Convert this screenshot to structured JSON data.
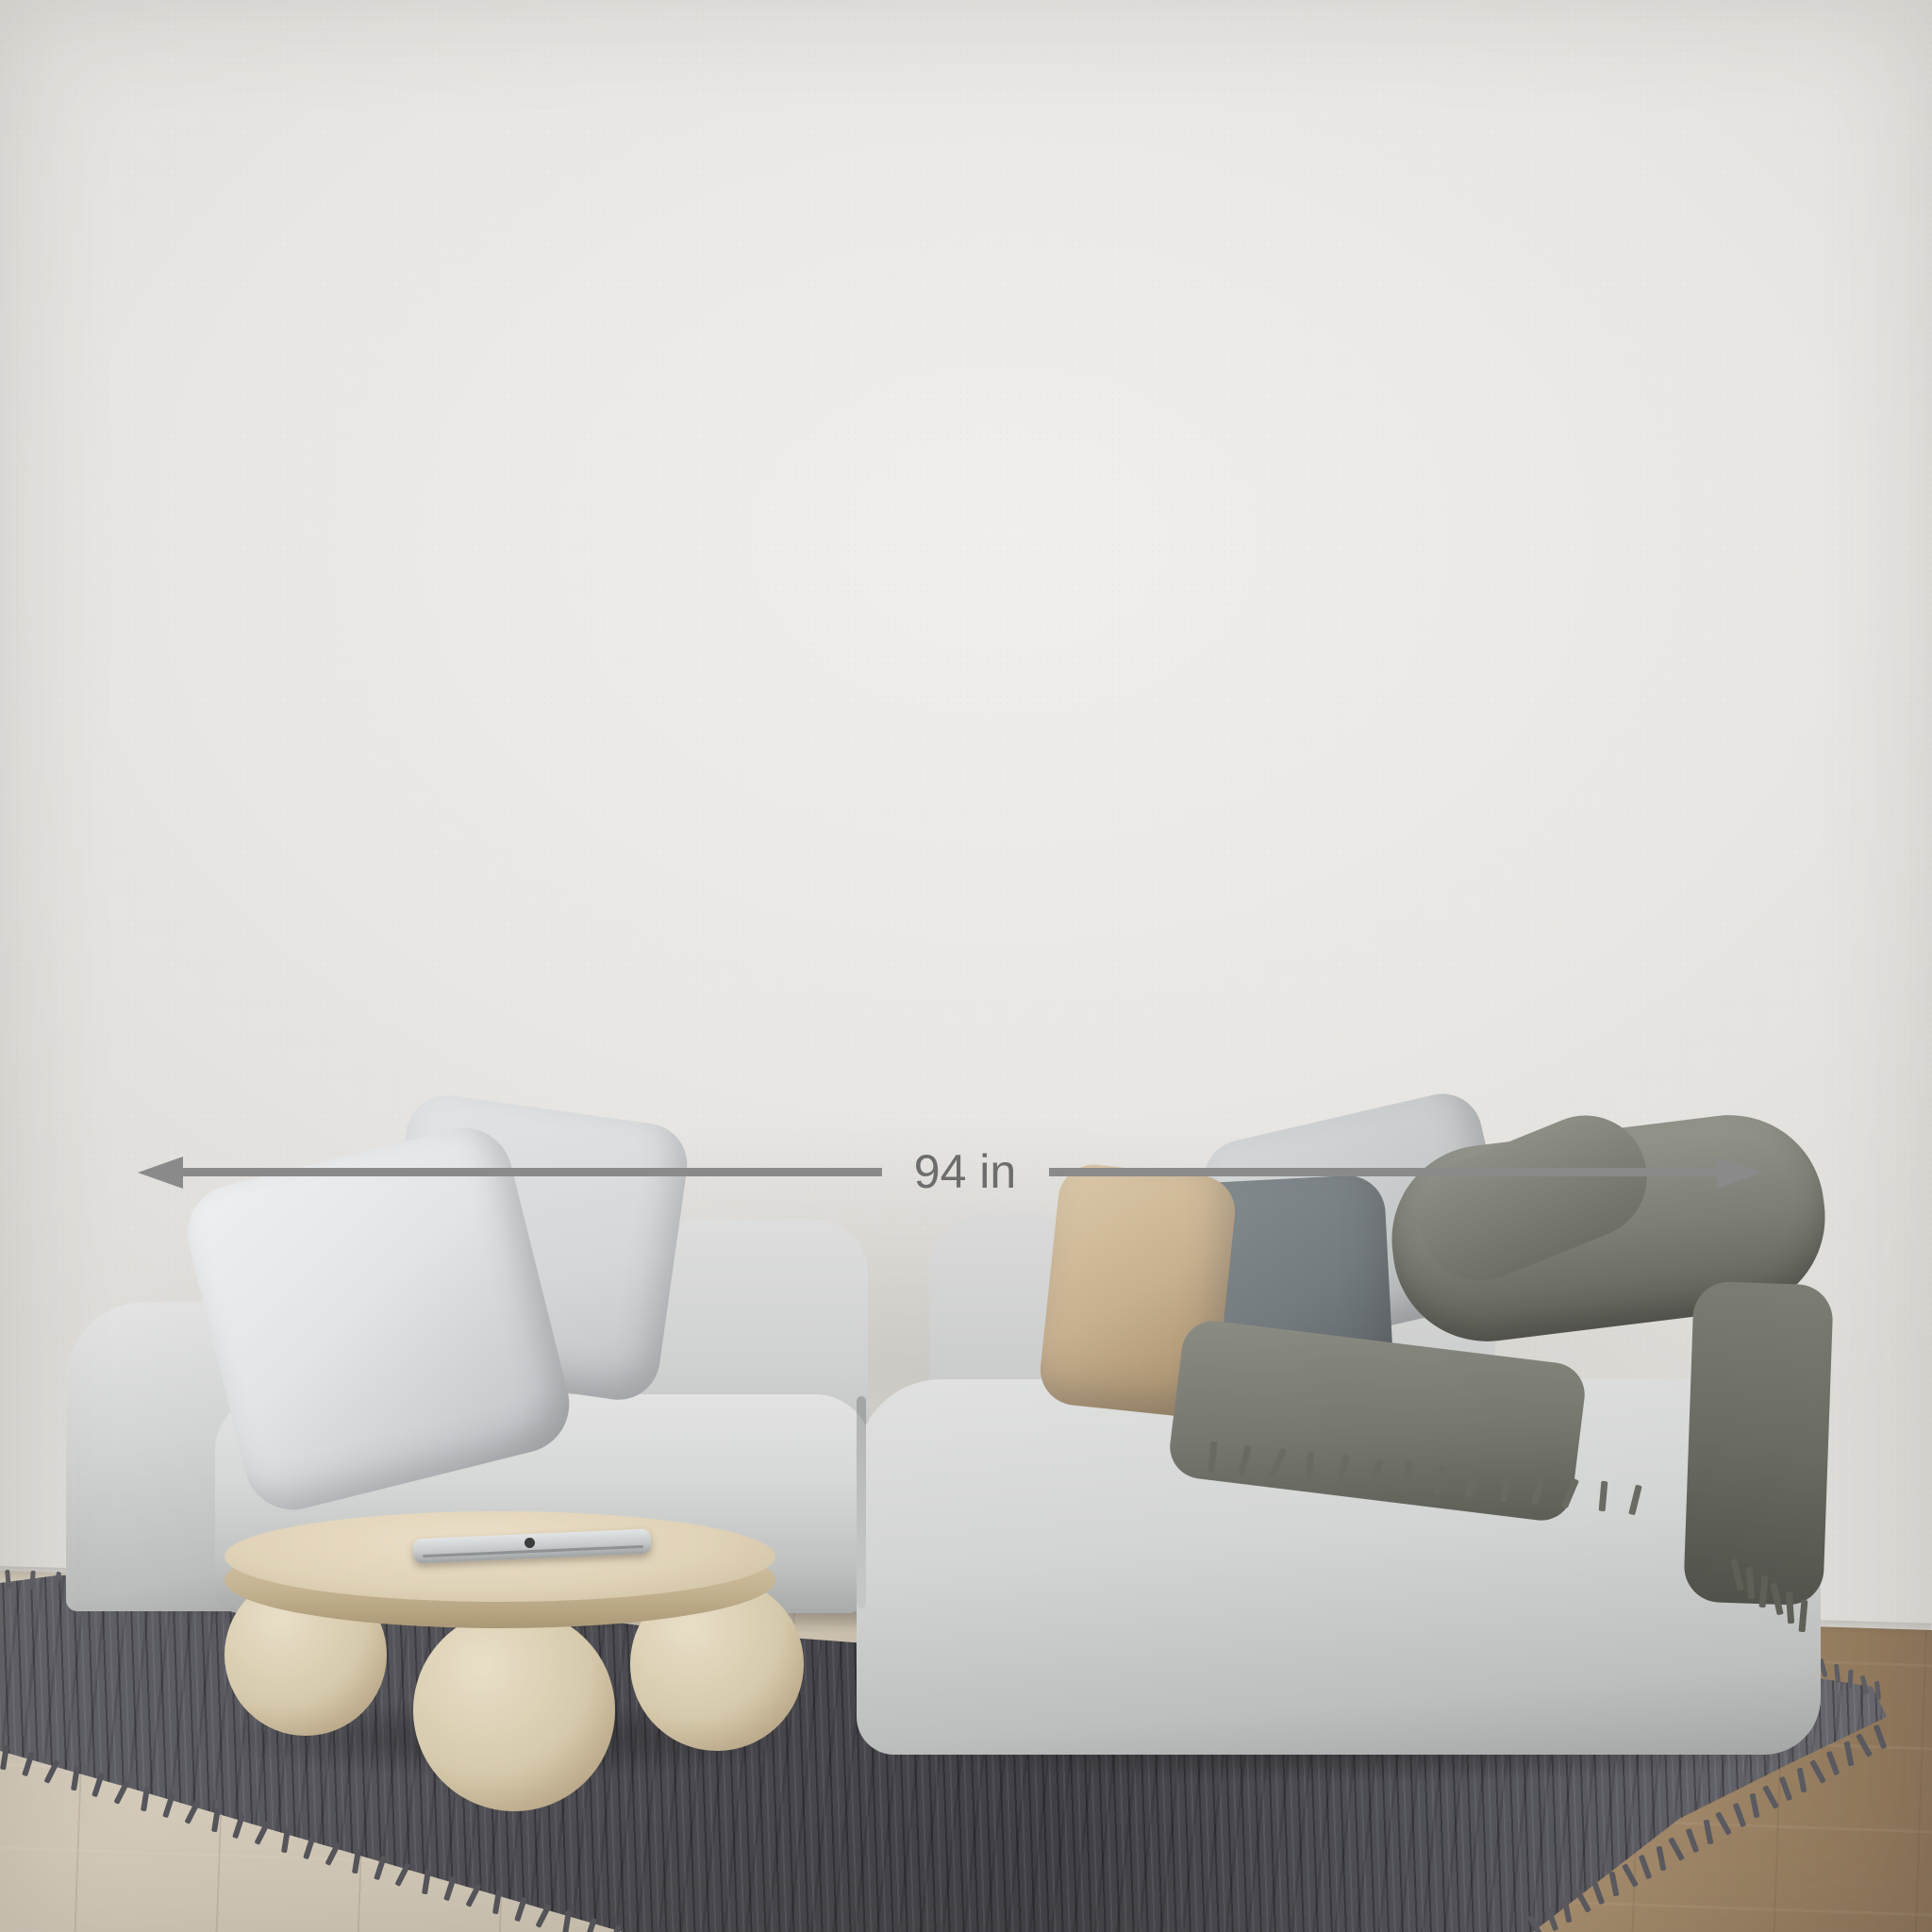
{
  "size_guide": {
    "line_color": "#7a7a7a",
    "label_color": "#747474",
    "sizes": [
      {
        "label": "90 in X 60 in",
        "width_in": 90,
        "height_in": 60
      },
      {
        "label": "72 in X 48 in",
        "width_in": 72,
        "height_in": 48
      },
      {
        "label": "60 in X 40 in",
        "width_in": 60,
        "height_in": 40
      },
      {
        "label": "48 in X 32 in",
        "width_in": 48,
        "height_in": 32
      },
      {
        "label": "36 in X 24 in",
        "width_in": 36,
        "height_in": 24
      },
      {
        "label": "24 in X 16 in",
        "width_in": 24,
        "height_in": 16
      }
    ]
  },
  "measurement": {
    "label": "94 in",
    "arrow_color": "#8a8a8a",
    "text_color": "#6d6d6d"
  },
  "scene": {
    "wall_color": "#e9e7e4",
    "floor_color_left": "#cfc6b5",
    "floor_color_right": "#8a7257",
    "rug_color": "#4c4c52",
    "sofa_color": "#d3d5d4",
    "pillow_colors": [
      "#e2e4e6",
      "#c8b190",
      "#747b7e",
      "#c6c9ca"
    ],
    "blanket_color": "#7d7f76",
    "table_color": "#e0d3b8"
  }
}
